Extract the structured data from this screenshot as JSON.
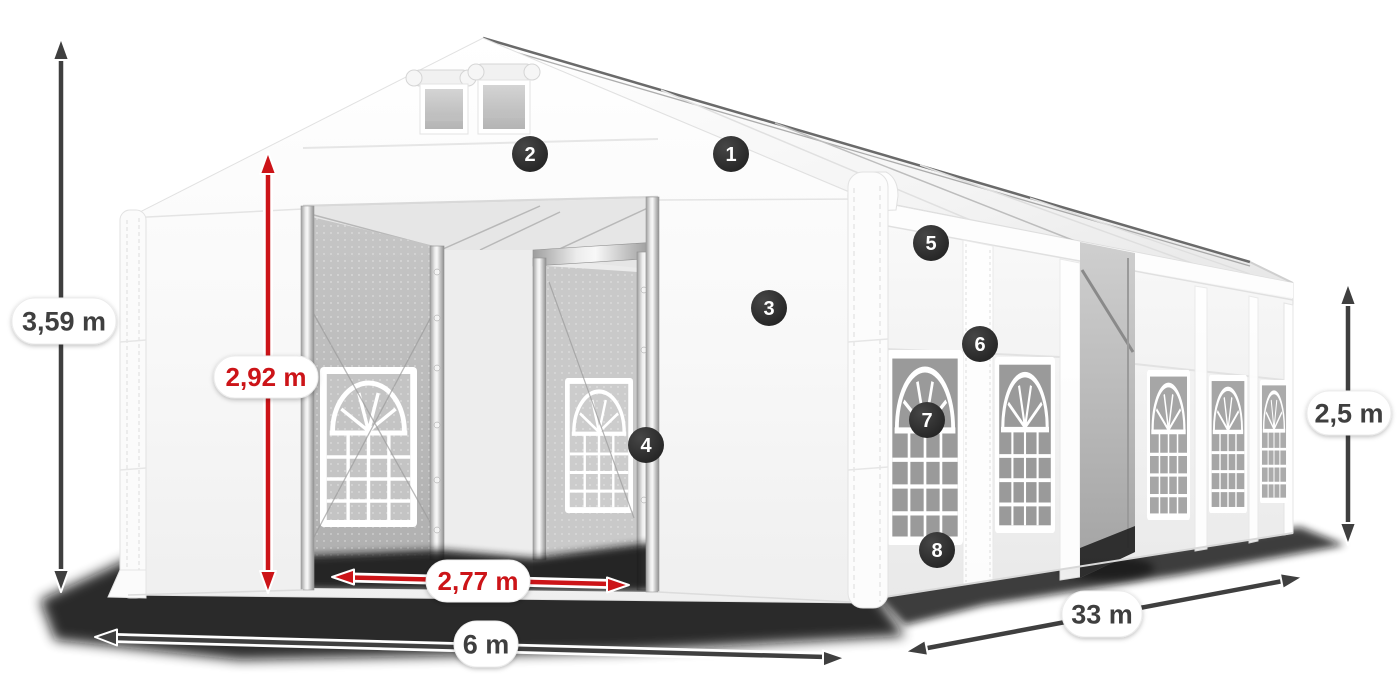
{
  "page": {
    "background_color": "#ffffff"
  },
  "illustration": {
    "subject": "marquee tent dimensions diagram",
    "colors": {
      "dimension_dark": "#3f3f3f",
      "dimension_red": "#cc1418",
      "badge_background": "#262626",
      "badge_text": "#ffffff",
      "tent_white": "#ffffff"
    },
    "dimensions": {
      "total_height": {
        "value": "3,59 m",
        "color": "dark"
      },
      "entrance_height": {
        "value": "2,92 m",
        "color": "red"
      },
      "entrance_width": {
        "value": "2,77 m",
        "color": "red"
      },
      "width": {
        "value": "6 m",
        "color": "dark"
      },
      "length": {
        "value": "33 m",
        "color": "dark"
      },
      "side_height": {
        "value": "2,5 m",
        "color": "dark"
      }
    },
    "hotspots": [
      {
        "number": "1"
      },
      {
        "number": "2"
      },
      {
        "number": "3"
      },
      {
        "number": "4"
      },
      {
        "number": "5"
      },
      {
        "number": "6"
      },
      {
        "number": "7"
      },
      {
        "number": "8"
      }
    ]
  }
}
